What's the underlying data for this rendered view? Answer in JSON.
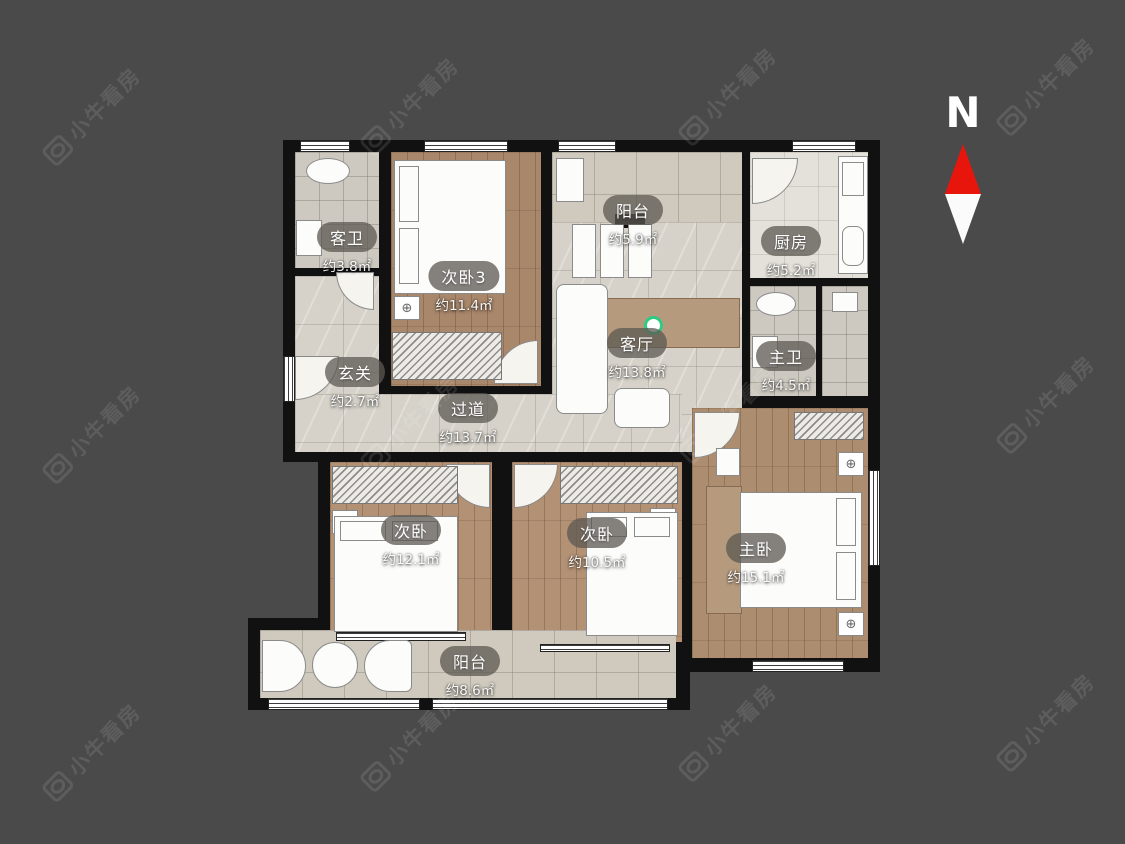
{
  "watermark": {
    "text": "小牛看房"
  },
  "compass": {
    "label": "N"
  },
  "icons": {
    "ac_vent": "⊕"
  },
  "rooms": [
    {
      "name": "客卫",
      "area": "约3.8㎡"
    },
    {
      "name": "次卧3",
      "area": "约11.4㎡"
    },
    {
      "name": "阳台",
      "area": "约5.9㎡"
    },
    {
      "name": "厨房",
      "area": "约5.2㎡"
    },
    {
      "name": "客厅",
      "area": "约13.8㎡"
    },
    {
      "name": "主卫",
      "area": "约4.5㎡"
    },
    {
      "name": "玄关",
      "area": "约2.7㎡"
    },
    {
      "name": "过道",
      "area": "约13.7㎡"
    },
    {
      "name": "次卧",
      "area": "约12.1㎡"
    },
    {
      "name": "次卧",
      "area": "约10.5㎡"
    },
    {
      "name": "主卧",
      "area": "约15.1㎡"
    },
    {
      "name": "阳台",
      "area": "约8.6㎡"
    }
  ]
}
